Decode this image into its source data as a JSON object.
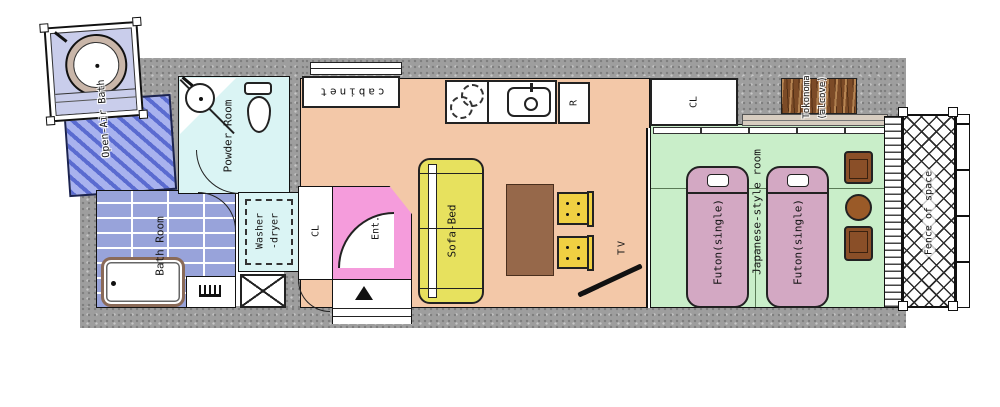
{
  "labels": {
    "open_air_bath": "Open-Air Bath",
    "powder_room": "Powder Room",
    "bath_room": "Bath Room",
    "washer_line1": "Washer",
    "washer_line2": "-dryer",
    "hall_closet": "CL",
    "entrance": "Ent.",
    "cabinet": "cabinet",
    "refrigerator": "R",
    "sofa_bed": "Sofa-Bed",
    "tv": "TV",
    "japanese_room": "Japanese-style room",
    "futon_1": "Futon(single)",
    "futon_2": "Futon(single)",
    "bedroom_closet": "CL",
    "alcove_line1": "Tokonoma",
    "alcove_line2": "(alcove)",
    "veranda": "Fence of space"
  },
  "colors": {
    "wall": "#9e9e9e",
    "oab-floor": "#c9cdeb",
    "deck-stripe": "#5a6bd0",
    "deck-bg": "#a8b2ee",
    "tile-floor": "#98a3da",
    "wet-floor": "#daf4f4",
    "living-floor": "#f3c8a8",
    "entrance-floor": "#f59cdc",
    "tatami-floor": "#c9eec9",
    "futon": "#d3a8c3",
    "sofa": "#e7e15e",
    "chair": "#f0d042",
    "table": "#96684a",
    "wood": "#7c4b27",
    "line": "#111111"
  }
}
